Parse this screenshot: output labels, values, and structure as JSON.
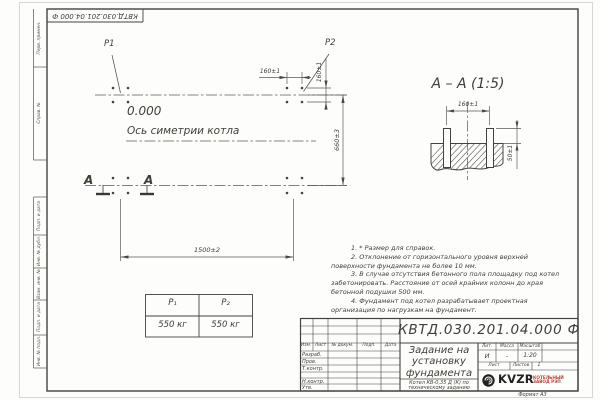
{
  "stamp_top": "КВТД.030.201.04.000 Ф",
  "margin_labels": [
    "Перв. примен.",
    "Справ. №",
    "Подп. и дата",
    "Инв. № дубл.",
    "Взам. инв. №",
    "Подп. и дата",
    "Инв. № подл."
  ],
  "plan": {
    "p1_label": "P1",
    "p2_label": "P2",
    "elevation": "0.000",
    "axis_label": "Ось симетрии котла",
    "section_letter": "А",
    "dim_width": "1500±2",
    "dim_height": "660±3",
    "dim_bolt_x": "160±1",
    "dim_bolt_y": "160±1"
  },
  "section": {
    "title": "А – А (1:5)",
    "dim_bolt_spacing": "160±1",
    "dim_protrusion": "50±1"
  },
  "notes": [
    "1. * Размер для справок.",
    "2. Отклонение от горизонтального уровня верхней поверхности фундамента не более 10 мм.",
    "3. В случае отсутствия бетонного пола площадку под котел забетонировать. Расстояние от осей крайних колонн до края бетонной подушки 500 мм.",
    "4. Фундамент под котел разрабатывает проектная организация по нагрузкам на фундамент."
  ],
  "load_table": {
    "headers": [
      "P₁",
      "P₂"
    ],
    "values": [
      "550 кг",
      "550 кг"
    ]
  },
  "title_block": {
    "doc_number": "КВТД.030.201.04.000  Ф",
    "title_lines": [
      "Задание на",
      "установку",
      "фундамента"
    ],
    "subtitle": "Котел КВ-0,35 Д (К) по техническому заданию",
    "header_cols": [
      "Изм.",
      "Лист",
      "№ докум.",
      "Подп.",
      "Дата"
    ],
    "sign_rows": [
      "Разраб.",
      "Пров.",
      "Т.контр.",
      "Н.контр.",
      "Утв."
    ],
    "lit_header": "Лит.",
    "mass_header": "Масса",
    "scale_header": "Масштаб",
    "lit_value": "И",
    "mass_value": "-",
    "scale_value": "1:20",
    "sheet_label": "Лист",
    "sheets_label": "Листов",
    "sheets_value": "1",
    "logo_text": "KVZR",
    "logo_caption_lines": [
      "КОТЕЛЬНЫЙ",
      "ЗАВОД РЭП"
    ],
    "logo_color": "#b0433a",
    "format_label": "Формат А3"
  }
}
